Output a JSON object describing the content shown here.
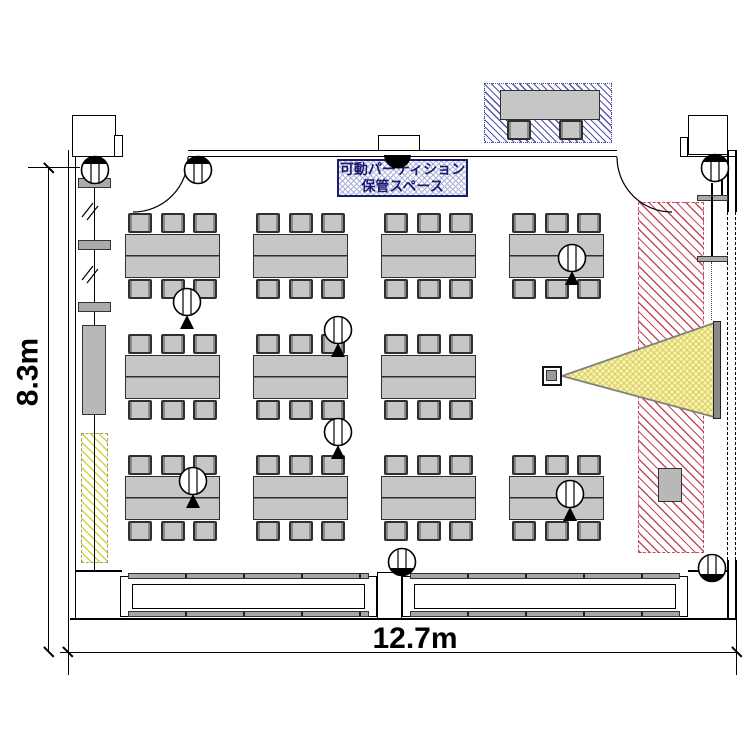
{
  "labels": {
    "dim_width": "12.7m",
    "dim_height": "8.3m",
    "partition_storage_line1": "可動パーティション",
    "partition_storage_line2": "保管スペース"
  },
  "colors": {
    "furniture_fill": "#c6c6c6",
    "furniture_border": "#2f2f2f",
    "hatch_blue": "#5055a8",
    "hatch_red": "#c34a5e",
    "hatch_yellow": "#d8ce45",
    "beam_fill": "#f8f4a8",
    "beam_hatch": "#d9cb6a",
    "screen_fill": "#8a8a8a",
    "label_navy": "#1a1a6e"
  },
  "layout": {
    "tables": {
      "col_x": [
        125,
        253,
        381,
        509
      ],
      "row_y": [
        234,
        355,
        476
      ],
      "w": 95,
      "h": 44,
      "chair_w": 24,
      "chair_h": 20,
      "chair_offsets": [
        3,
        35.5,
        68
      ],
      "positions": [
        [
          0,
          0
        ],
        [
          1,
          0
        ],
        [
          2,
          0
        ],
        [
          3,
          0
        ],
        [
          0,
          1
        ],
        [
          1,
          1
        ],
        [
          2,
          1
        ],
        [
          0,
          2
        ],
        [
          1,
          2
        ],
        [
          2,
          2
        ],
        [
          3,
          2
        ]
      ]
    },
    "ceiling_symbols": [
      {
        "x": 187,
        "y": 302
      },
      {
        "x": 572,
        "y": 258
      },
      {
        "x": 338,
        "y": 330
      },
      {
        "x": 338,
        "y": 432
      },
      {
        "x": 193,
        "y": 481
      },
      {
        "x": 570,
        "y": 494
      }
    ],
    "wall_symbols": [
      {
        "x": 95,
        "y": 170,
        "arc": "top"
      },
      {
        "x": 198,
        "y": 170,
        "arc": "top"
      },
      {
        "x": 715,
        "y": 168,
        "arc": "top"
      },
      {
        "x": 402,
        "y": 562,
        "arc": "bottom"
      },
      {
        "x": 712,
        "y": 568,
        "arc": "bottom"
      }
    ]
  }
}
